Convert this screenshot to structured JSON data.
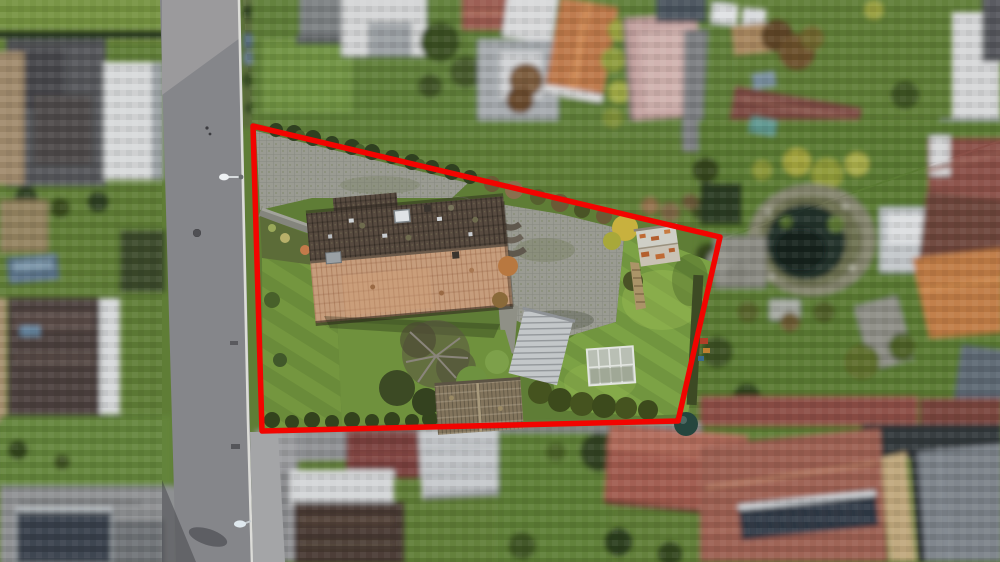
{
  "scene": {
    "kind": "aerial-drone-photograph",
    "subject": "residential property outlined with red boundary, neighbouring parcels pixelated for privacy"
  },
  "boundary": {
    "points": "253,126 720,237 678,421 262,431",
    "color": "#f20400",
    "stroke_width": 5.5
  },
  "palette": {
    "neighbor_lawn": "#5f7d36",
    "property_lawn": "#7ca245",
    "property_lawn_left": "#74963f",
    "road_asphalt": "#85868a",
    "curb_white": "#dcdcd8",
    "sidewalk": "#a4a5a7",
    "paving": "#9a9b92",
    "roof_north": "#574a3f",
    "roof_south": "#c69d7c",
    "roof_ridge": "#6b5a4a",
    "garage_roof": "#82745c",
    "carport_roof": "#c3c7c9",
    "shed_roof": "#cfcfc6",
    "greenhouse_roof": "#b9bfb4",
    "walkway_wood": "#ab9468",
    "pond_water": "#20302a",
    "pond_stone": "#85856e",
    "solar_panel": "#2f3944",
    "neighbor_roof_red": "#9c5e51",
    "neighbor_roof_orange": "#c07c44",
    "neighbor_roof_maroon": "#7b4a42",
    "building_white": "#d6d7d8",
    "hedge_dark": "#2f4020",
    "tank_teal": "#26463e"
  }
}
